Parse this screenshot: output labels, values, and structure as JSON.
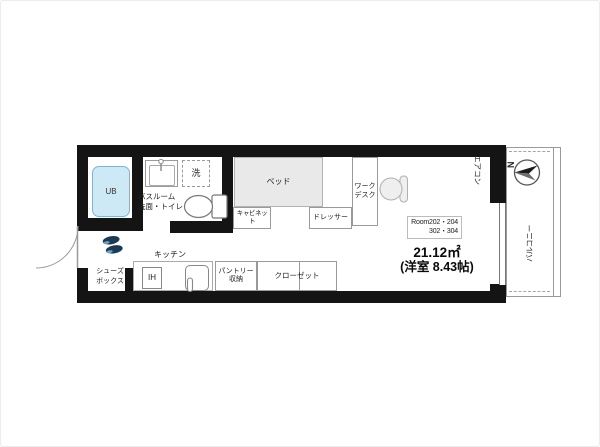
{
  "labels": {
    "ub": "UB",
    "bathroom_line1": "バスルーム",
    "bathroom_line2": "洗面・トイレ",
    "washer": "洗",
    "bed": "ベッド",
    "cabinet": "キャビネット",
    "dresser": "ドレッサー",
    "desk_line1": "ワーク",
    "desk_line2": "デスク",
    "kitchen": "キッチン",
    "ih": "IH",
    "pantry_line1": "パントリー",
    "pantry_line2": "収納",
    "closet": "クローゼット",
    "shoebox_line1": "シューズ",
    "shoebox_line2": "ボックス",
    "aircon": "エアコン",
    "balcony": "バルコニー",
    "compass_north": "N"
  },
  "room_info": {
    "rooms_line1": "Room202・204",
    "rooms_line2": "302・304",
    "area": "21.12㎡",
    "layout": "(洋室 8.43帖)"
  },
  "colors": {
    "wall": "#141414",
    "tub": "#cde9f6",
    "bed": "#e9e9e9",
    "shoes": "#1a3b53"
  }
}
